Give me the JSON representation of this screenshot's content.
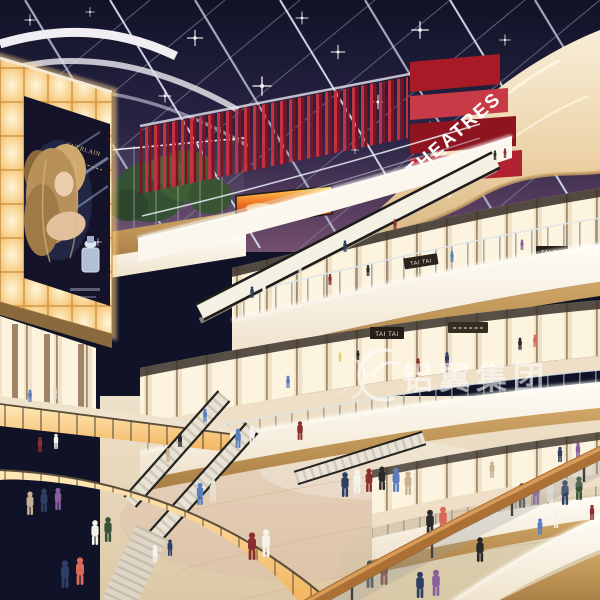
{
  "signs": {
    "theatre_marquee": "THEATRES",
    "billboard_brand": "GUERLAIN",
    "store_sign_upper_right": "TAI TAI",
    "store_sign_upper_mid": "TAI TAI",
    "store_sign_lower": "TAI TAI",
    "watermark": "铝翼集团"
  },
  "colors": {
    "sky_top": "#101327",
    "sky_horizon": "#74506d",
    "theatre_red": "#c23240",
    "theatre_red_dark": "#7e1220",
    "balcony_cream": "#f2e3c9",
    "wood_trim": "#c49a5e",
    "glow_wall": "#ffd9a0",
    "floor_beige": "#e6d7bd",
    "handrail_wood": "#ad7034",
    "led_flame_orange": "#f07020"
  },
  "people": {
    "figures": [
      {
        "x": 345,
        "y": 497,
        "s": 0.9,
        "c": "#2e3f63"
      },
      {
        "x": 357,
        "y": 494,
        "s": 0.9,
        "c": "#f5f2ea"
      },
      {
        "x": 369,
        "y": 492,
        "s": 0.85,
        "c": "#8a2f2f"
      },
      {
        "x": 382,
        "y": 490,
        "s": 0.85,
        "c": "#27292b"
      },
      {
        "x": 396,
        "y": 492,
        "s": 0.88,
        "c": "#5a7fc0"
      },
      {
        "x": 408,
        "y": 495,
        "s": 0.85,
        "c": "#c9b294"
      },
      {
        "x": 522,
        "y": 508,
        "s": 0.9,
        "c": "#4a4e56"
      },
      {
        "x": 536,
        "y": 505,
        "s": 0.9,
        "c": "#8a5f9e"
      },
      {
        "x": 550,
        "y": 502,
        "s": 0.85,
        "c": "#f5f2ea"
      },
      {
        "x": 565,
        "y": 505,
        "s": 0.9,
        "c": "#2e3f63"
      },
      {
        "x": 579,
        "y": 500,
        "s": 0.85,
        "c": "#36543a"
      },
      {
        "x": 430,
        "y": 536,
        "s": 0.95,
        "c": "#27292b"
      },
      {
        "x": 443,
        "y": 533,
        "s": 0.95,
        "c": "#d96a5a"
      },
      {
        "x": 252,
        "y": 560,
        "s": 1,
        "c": "#8a2f2f"
      },
      {
        "x": 266,
        "y": 557,
        "s": 1,
        "c": "#f5f2ea"
      },
      {
        "x": 200,
        "y": 505,
        "s": 0.8,
        "c": "#5a7fc0"
      },
      {
        "x": 213,
        "y": 502,
        "s": 0.8,
        "c": "#e8e0d0"
      },
      {
        "x": 370,
        "y": 588,
        "s": 1,
        "c": "#4a4e56"
      },
      {
        "x": 384,
        "y": 585,
        "s": 1,
        "c": "#7a4a3a"
      },
      {
        "x": 30,
        "y": 515,
        "s": 0.85,
        "c": "#c9b294"
      },
      {
        "x": 44,
        "y": 512,
        "s": 0.85,
        "c": "#2e3f63"
      },
      {
        "x": 58,
        "y": 510,
        "s": 0.8,
        "c": "#8a5f9e"
      },
      {
        "x": 95,
        "y": 545,
        "s": 0.9,
        "c": "#f5f2ea"
      },
      {
        "x": 108,
        "y": 542,
        "s": 0.9,
        "c": "#36543a"
      },
      {
        "x": 65,
        "y": 588,
        "s": 1,
        "c": "#2e3f63"
      },
      {
        "x": 80,
        "y": 585,
        "s": 1,
        "c": "#d96a5a"
      },
      {
        "x": 480,
        "y": 562,
        "s": 0.9,
        "c": "#27292b"
      },
      {
        "x": 540,
        "y": 535,
        "s": 0.6,
        "c": "#5a7fc0"
      },
      {
        "x": 556,
        "y": 528,
        "s": 0.6,
        "c": "#f5f2ea"
      },
      {
        "x": 592,
        "y": 520,
        "s": 0.55,
        "c": "#8a2f2f"
      },
      {
        "x": 492,
        "y": 478,
        "s": 0.6,
        "c": "#c9b294"
      },
      {
        "x": 560,
        "y": 462,
        "s": 0.55,
        "c": "#2e3f63"
      },
      {
        "x": 578,
        "y": 458,
        "s": 0.55,
        "c": "#8a5f9e"
      },
      {
        "x": 594,
        "y": 462,
        "s": 0.55,
        "c": "#f5f2ea"
      },
      {
        "x": 418,
        "y": 372,
        "s": 0.5,
        "c": "#8a2f2f"
      },
      {
        "x": 432,
        "y": 369,
        "s": 0.5,
        "c": "#f5f2ea"
      },
      {
        "x": 447,
        "y": 366,
        "s": 0.5,
        "c": "#2e3f63"
      },
      {
        "x": 288,
        "y": 388,
        "s": 0.45,
        "c": "#5a7fc0"
      },
      {
        "x": 301,
        "y": 385,
        "s": 0.45,
        "c": "#e8e0d0"
      },
      {
        "x": 520,
        "y": 350,
        "s": 0.45,
        "c": "#27292b"
      },
      {
        "x": 535,
        "y": 347,
        "s": 0.45,
        "c": "#d96a5a"
      },
      {
        "x": 252,
        "y": 298,
        "s": 0.42,
        "c": "#2e3f63"
      },
      {
        "x": 264,
        "y": 295,
        "s": 0.42,
        "c": "#f5f2ea"
      },
      {
        "x": 330,
        "y": 285,
        "s": 0.4,
        "c": "#8a2f2f"
      },
      {
        "x": 368,
        "y": 276,
        "s": 0.4,
        "c": "#27292b"
      },
      {
        "x": 452,
        "y": 262,
        "s": 0.4,
        "c": "#5a7fc0"
      },
      {
        "x": 522,
        "y": 250,
        "s": 0.38,
        "c": "#8a5f9e"
      },
      {
        "x": 300,
        "y": 272,
        "s": 0.42,
        "c": "#f5f2ea"
      },
      {
        "x": 345,
        "y": 252,
        "s": 0.42,
        "c": "#2e3f63"
      },
      {
        "x": 395,
        "y": 230,
        "s": 0.4,
        "c": "#8a2f2f"
      },
      {
        "x": 180,
        "y": 447,
        "s": 0.5,
        "c": "#27292b"
      },
      {
        "x": 168,
        "y": 462,
        "s": 0.5,
        "c": "#c9b294"
      },
      {
        "x": 205,
        "y": 422,
        "s": 0.48,
        "c": "#5a7fc0"
      },
      {
        "x": 155,
        "y": 562,
        "s": 0.62,
        "c": "#f5f2ea"
      },
      {
        "x": 170,
        "y": 556,
        "s": 0.6,
        "c": "#2e3f63"
      },
      {
        "x": 40,
        "y": 452,
        "s": 0.55,
        "c": "#8a2f2f"
      },
      {
        "x": 56,
        "y": 449,
        "s": 0.55,
        "c": "#f5f2ea"
      },
      {
        "x": 30,
        "y": 402,
        "s": 0.45,
        "c": "#5a7fc0"
      },
      {
        "x": 55,
        "y": 399,
        "s": 0.45,
        "c": "#e8e0d0"
      },
      {
        "x": 495,
        "y": 160,
        "s": 0.35,
        "c": "#27292b"
      },
      {
        "x": 505,
        "y": 158,
        "s": 0.35,
        "c": "#8a2f2f"
      },
      {
        "x": 340,
        "y": 362,
        "s": 0.35,
        "c": "#ddd06a"
      },
      {
        "x": 358,
        "y": 360,
        "s": 0.35,
        "c": "#27292b"
      },
      {
        "x": 470,
        "y": 350,
        "s": 0.33,
        "c": "#f5f2ea"
      },
      {
        "x": 238,
        "y": 448,
        "s": 0.7,
        "c": "#5a7fc0"
      },
      {
        "x": 252,
        "y": 445,
        "s": 0.7,
        "c": "#f5f2ea"
      },
      {
        "x": 300,
        "y": 440,
        "s": 0.68,
        "c": "#8a2f2f"
      },
      {
        "x": 420,
        "y": 598,
        "s": 0.95,
        "c": "#2e3f63"
      },
      {
        "x": 436,
        "y": 596,
        "s": 0.95,
        "c": "#8a5f9e"
      }
    ]
  }
}
